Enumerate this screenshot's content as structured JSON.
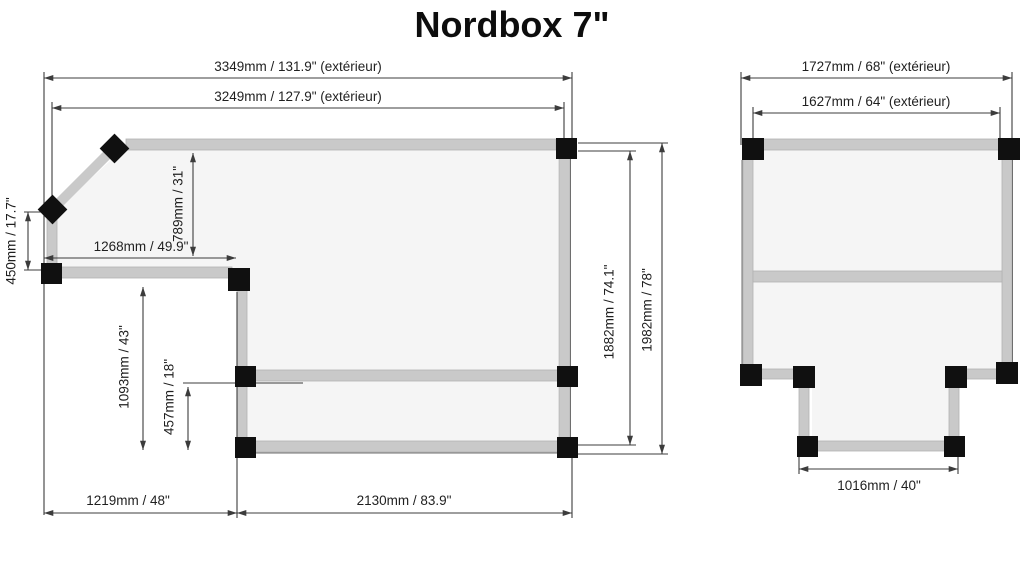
{
  "title": "Nordbox 7\"",
  "colors": {
    "background": "#ffffff",
    "rail": "#c9c9c9",
    "connector": "#101010",
    "dimension_line": "#3c3c3c",
    "label_text": "#1f1f1f",
    "interior_fill": "#f5f5f5"
  },
  "left_diagram": {
    "name": "main floor frame with chamfered corner and notch",
    "labels": {
      "top_outer": "3349mm / 131.9\" (extérieur)",
      "top_inner": "3249mm / 127.9\" (extérieur)",
      "left_height": "450mm / 17.7\"",
      "upper_interior_height": "789mm / 31\"",
      "step_width": "1268mm / 49.9\"",
      "notch_height": "1093mm / 43\"",
      "lower_interior_height": "457mm / 18\"",
      "right_inner_height": "1882mm / 74.1\"",
      "right_outer_height": "1982mm / 78\"",
      "bottom_left_width": "1219mm / 48\"",
      "bottom_right_width": "2130mm / 83.9\""
    }
  },
  "right_diagram": {
    "name": "secondary frame with bottom tab",
    "labels": {
      "top_outer": "1727mm / 68\" (extérieur)",
      "top_inner": "1627mm / 64\" (extérieur)",
      "bottom_tab_width": "1016mm / 40\""
    }
  }
}
